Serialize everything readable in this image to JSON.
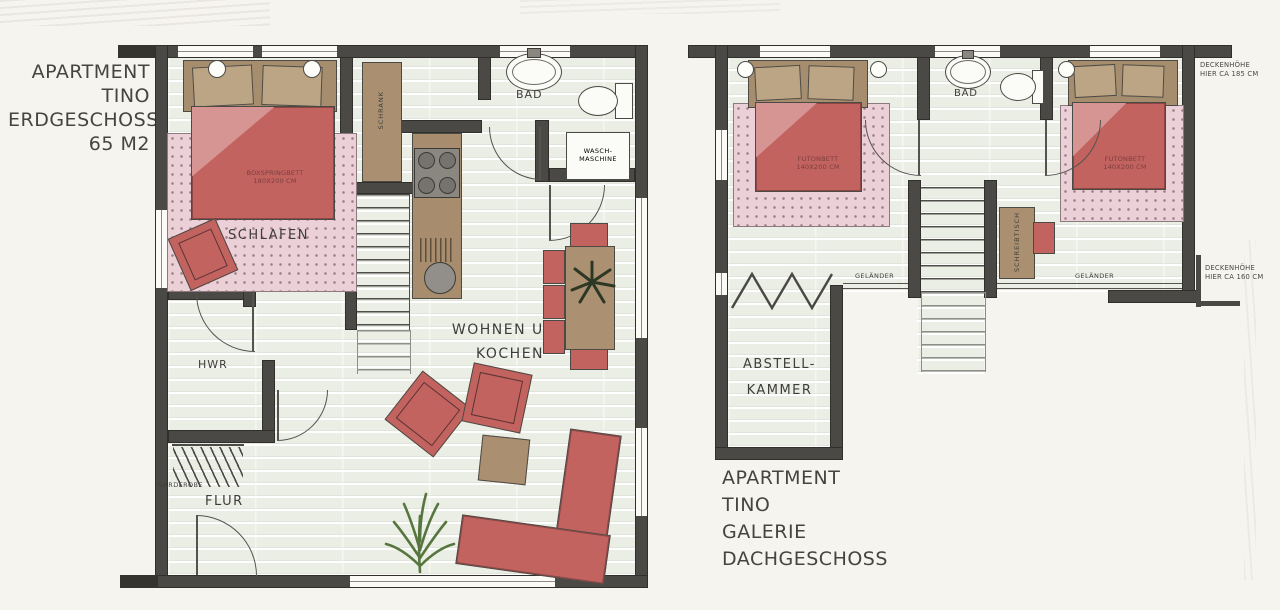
{
  "colors": {
    "paper": "#f6f4ee",
    "wall": "#4b4945",
    "floor": "#ebeee5",
    "carpet": "#ecd0d7",
    "furniture_red": "#c26360",
    "furniture_tan": "#aa9070",
    "plant_green": "#57763f"
  },
  "left_plan": {
    "title": [
      "APARTMENT",
      "TINO",
      "ERDGESCHOSS",
      "65 M2"
    ],
    "labels": {
      "bedroom": "SCHLAFEN",
      "bath": "BAD",
      "living1": "WOHNEN UND",
      "living2": "KOCHEN",
      "utility": "HWR",
      "hall": "FLUR",
      "wardrobe_rack": "GARDEROBE",
      "closet": "SCHRANK",
      "bed1": "BOXSPRINGBETT",
      "bed2": "180X200 CM",
      "washer1": "WASCH-",
      "washer2": "MASCHINE"
    }
  },
  "right_plan": {
    "title": [
      "APARTMENT",
      "TINO",
      "GALERIE",
      "DACHGESCHOSS"
    ],
    "labels": {
      "bath": "BAD",
      "bed_left1": "FUTONBETT",
      "bed_left2": "140X200 CM",
      "bed_right1": "FUTONBETT",
      "bed_right2": "140X200 CM",
      "desk": "SCHREIBTISCH",
      "railing_left": "GELÄNDER",
      "railing_right": "GELÄNDER",
      "storage1": "ABSTELL-",
      "storage2": "KAMMER",
      "note_top1": "DECKENHÖHE",
      "note_top2": "HIER CA 185 CM",
      "note_bottom1": "DECKENHÖHE",
      "note_bottom2": "HIER CA 160 CM"
    }
  }
}
